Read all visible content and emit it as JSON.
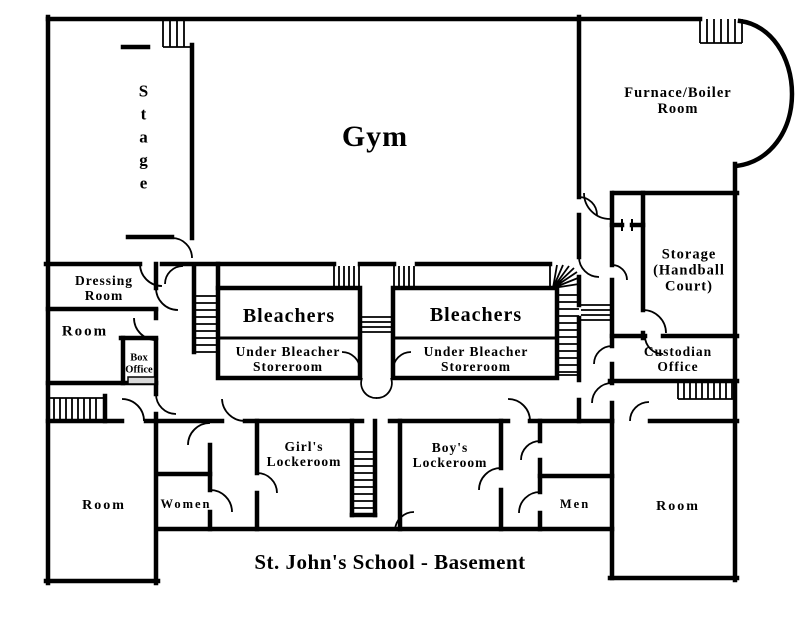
{
  "title": "St. John's School - Basement",
  "colors": {
    "wall": "#000000",
    "background": "#ffffff",
    "window_fill": "#d9d9d9"
  },
  "rooms": {
    "stage": {
      "label": "Stage",
      "letters": [
        "S",
        "t",
        "a",
        "g",
        "e"
      ]
    },
    "gym": {
      "label": "Gym"
    },
    "furnace": {
      "line1": "Furnace/Boiler",
      "line2": "Room"
    },
    "dressing": {
      "line1": "Dressing",
      "line2": "Room"
    },
    "room_mid_left": {
      "label": "Room"
    },
    "box_office": {
      "line1": "Box",
      "line2": "Office"
    },
    "bleachers_left": {
      "label": "Bleachers"
    },
    "storeroom_left": {
      "line1": "Under Bleacher",
      "line2": "Storeroom"
    },
    "bleachers_right": {
      "label": "Bleachers"
    },
    "storeroom_right": {
      "line1": "Under Bleacher",
      "line2": "Storeroom"
    },
    "storage": {
      "line1": "Storage",
      "line2": "(Handball",
      "line3": "Court)"
    },
    "custodian": {
      "line1": "Custodian",
      "line2": "Office"
    },
    "girls_lockeroom": {
      "line1": "Girl's",
      "line2": "Lockeroom"
    },
    "boys_lockeroom": {
      "line1": "Boy's",
      "line2": "Lockeroom"
    },
    "women": {
      "label": "Women"
    },
    "men": {
      "label": "Men"
    },
    "room_bottom_left": {
      "label": "Room"
    },
    "room_bottom_right": {
      "label": "Room"
    }
  }
}
